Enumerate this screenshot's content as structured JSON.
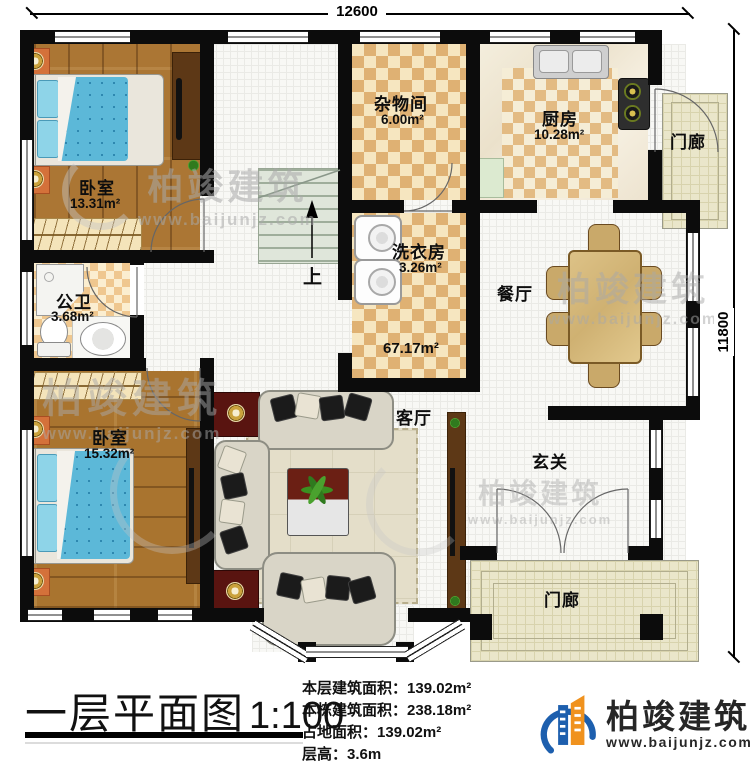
{
  "dimensions": {
    "width_label": "12600",
    "height_label": "11800"
  },
  "rooms": {
    "bedroom1": {
      "name": "卧室",
      "area": "13.31m²"
    },
    "storage": {
      "name": "杂物间",
      "area": "6.00m²"
    },
    "kitchen": {
      "name": "厨房",
      "area": "10.28m²"
    },
    "porch_top": {
      "name": "门廊"
    },
    "laundry": {
      "name": "洗衣房",
      "area": "3.26m²"
    },
    "bathroom": {
      "name": "公卫",
      "area": "3.68m²"
    },
    "dining": {
      "name": "餐厅"
    },
    "living": {
      "name": "客厅",
      "area": "67.17m²"
    },
    "bedroom2": {
      "name": "卧室",
      "area": "15.32m²"
    },
    "foyer": {
      "name": "玄关"
    },
    "porch_bottom": {
      "name": "门廊"
    },
    "stairs": {
      "up_label": "上"
    }
  },
  "footer": {
    "title": "一层平面图",
    "scale": "1:100",
    "stats": [
      {
        "label": "本层建筑面积：",
        "value": "139.02m²"
      },
      {
        "label": "本栋建筑面积：",
        "value": "238.18m²"
      },
      {
        "label": "占地面积：",
        "value": "139.02m²"
      },
      {
        "label": "层高：",
        "value": "3.6m"
      }
    ],
    "brand": {
      "name": "柏竣建筑",
      "url": "www.baijunjz.com"
    }
  },
  "watermark": {
    "name": "柏竣建筑",
    "url": "www.baijunjz.com"
  },
  "colors": {
    "wall": "#0c0c0c",
    "wood": "#ab7634",
    "checker_dark": "#dfb173",
    "bed_blanket": "#5cb8d8",
    "brand_blue": "#1d5fae",
    "brand_orange": "#f0921e"
  }
}
